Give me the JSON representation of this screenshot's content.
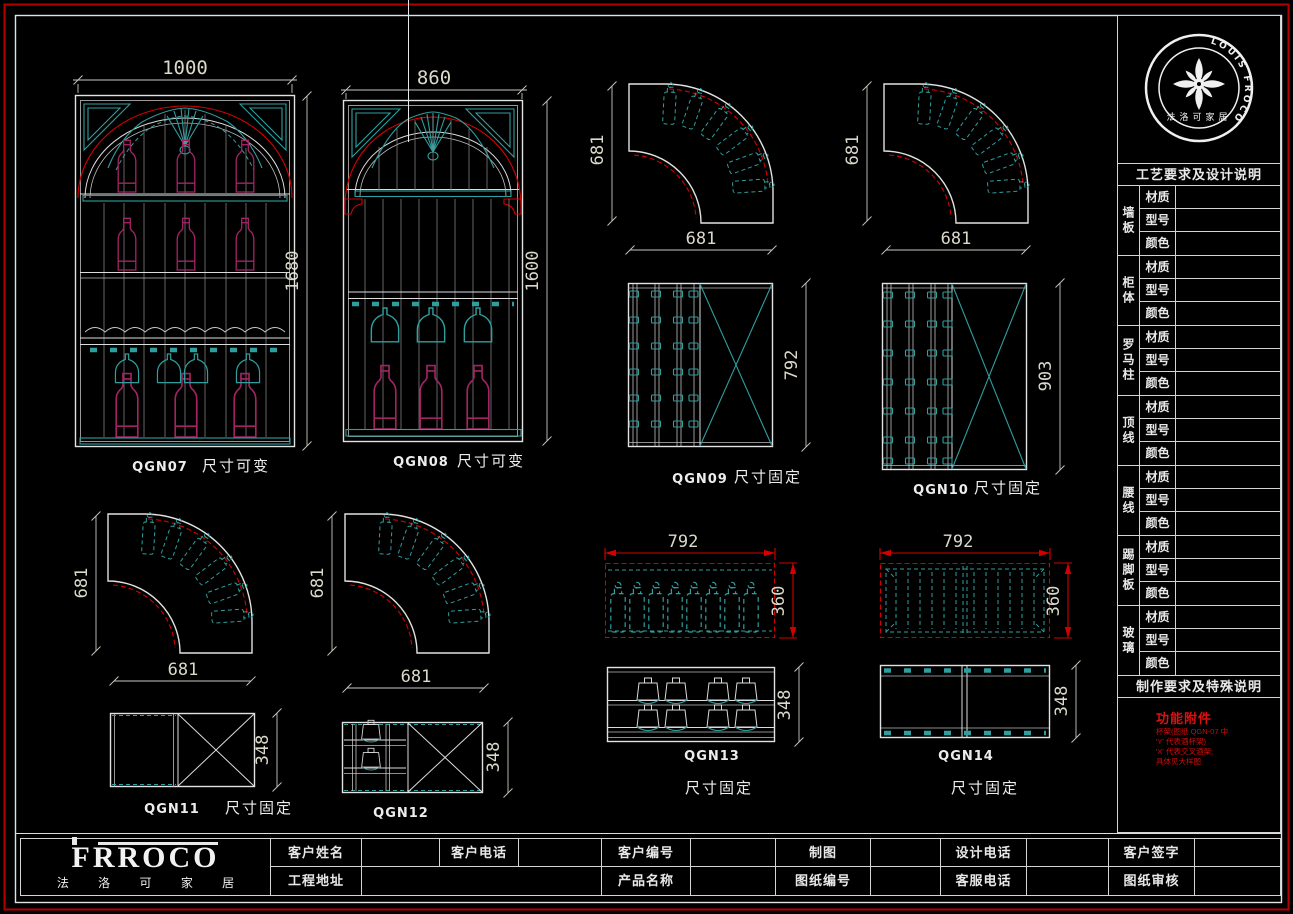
{
  "colors": {
    "teal": "#2f9e9e",
    "magenta": "#a32464",
    "dim_red": "#d40000",
    "line_white": "#dcdcdc"
  },
  "cab": {
    "q07": {
      "id": "QGN07",
      "note": "尺寸可变",
      "w": "1000",
      "h": "1680"
    },
    "q08": {
      "id": "QGN08",
      "note": "尺寸可变",
      "w": "860",
      "h": "1600"
    },
    "q09": {
      "id": "QGN09",
      "note": "尺寸固定",
      "h": "792"
    },
    "q10": {
      "id": "QGN10",
      "note": "尺寸固定",
      "h": "903"
    },
    "q11": {
      "id": "QGN11",
      "note": "尺寸固定",
      "h": "348"
    },
    "q12": {
      "id": "QGN12",
      "h": "348"
    },
    "q13": {
      "id": "QGN13",
      "note": "尺寸固定",
      "pw": "792",
      "ph": "360",
      "fh": "348"
    },
    "q14": {
      "id": "QGN14",
      "note": "尺寸固定",
      "pw": "792",
      "ph": "360",
      "fh": "348"
    },
    "arc": {
      "d": "681"
    }
  },
  "seal": {
    "ring": "LOUIS FROCO",
    "cn": "法洛可家居"
  },
  "spec": {
    "header": "工艺要求及设计说明",
    "attrs": {
      "m": "材质",
      "t": "型号",
      "c": "颜色"
    },
    "groups": [
      "墙板",
      "柜体",
      "罗马柱",
      "顶线",
      "腰线",
      "踢脚板",
      "玻璃"
    ],
    "notes_header": "制作要求及特殊说明",
    "notes_title": "功能附件",
    "notes": [
      "杯架(图纸 QGN-07 中",
      "'Y' 代表酒杯架)",
      "'X' 代表交叉酒架;",
      "具体见大样图"
    ]
  },
  "tb": {
    "brand": "FRROCO",
    "cn": "法 洛 可 家 居",
    "r1": [
      "客户姓名",
      "客户电话",
      "客户编号",
      "制图",
      "设计电话",
      "客户签字"
    ],
    "r2": [
      "工程地址",
      "产品名称",
      "图纸编号",
      "客服电话",
      "图纸审核"
    ]
  }
}
